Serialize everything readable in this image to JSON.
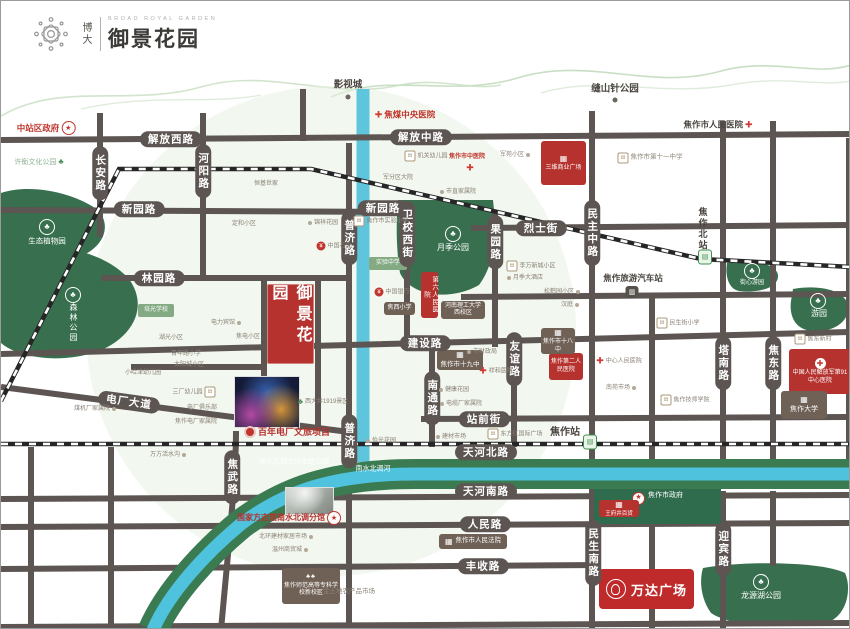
{
  "logo": {
    "brand": "博大",
    "en": "BROAD ROYAL GARDEN",
    "name": "御景花园"
  },
  "project": {
    "name": "御景花园"
  },
  "wanda": {
    "name": "万达广场"
  },
  "colors": {
    "road": "#5c5552",
    "park": "#38704f",
    "water": "#5ec5dd",
    "band_green": "#3b7b52",
    "accent_red": "#b5322e",
    "box_brown": "#6f6156",
    "tiny_text": "#8b8276",
    "red_text": "#c0362c"
  },
  "map": {
    "road_labels_h": [
      {
        "t": "解放西路",
        "x": 170,
        "y": 138
      },
      {
        "t": "解放中路",
        "x": 420,
        "y": 136
      },
      {
        "t": "新园路",
        "x": 138,
        "y": 208
      },
      {
        "t": "新园路",
        "x": 382,
        "y": 207
      },
      {
        "t": "林园路",
        "x": 158,
        "y": 277
      },
      {
        "t": "烈士街",
        "x": 540,
        "y": 227
      },
      {
        "t": "建设路",
        "x": 424,
        "y": 342
      },
      {
        "t": "电厂大道",
        "x": 128,
        "y": 401,
        "r": 8
      },
      {
        "t": "站前街",
        "x": 483,
        "y": 418
      },
      {
        "t": "天河北路",
        "x": 485,
        "y": 451
      },
      {
        "t": "天河南路",
        "x": 485,
        "y": 490
      },
      {
        "t": "人民路",
        "x": 484,
        "y": 523
      },
      {
        "t": "丰收路",
        "x": 482,
        "y": 565
      }
    ],
    "road_labels_v": [
      {
        "t": "长安路",
        "x": 99,
        "y": 172
      },
      {
        "t": "河阳路",
        "x": 202,
        "y": 170
      },
      {
        "t": "普济路",
        "x": 348,
        "y": 237
      },
      {
        "t": "普济路",
        "x": 348,
        "y": 440
      },
      {
        "t": "焦武路",
        "x": 231,
        "y": 476
      },
      {
        "t": "卫校西街",
        "x": 406,
        "y": 233
      },
      {
        "t": "果园路",
        "x": 494,
        "y": 241
      },
      {
        "t": "民主中路",
        "x": 591,
        "y": 232
      },
      {
        "t": "友谊路",
        "x": 513,
        "y": 358
      },
      {
        "t": "南通路",
        "x": 431,
        "y": 397
      },
      {
        "t": "塔南路",
        "x": 722,
        "y": 362
      },
      {
        "t": "焦东路",
        "x": 772,
        "y": 362
      },
      {
        "t": "民生南路",
        "x": 592,
        "y": 552
      },
      {
        "t": "迎宾路",
        "x": 722,
        "y": 548
      }
    ],
    "boxes": [
      {
        "t": "焦作市政府",
        "x": 593,
        "y": 488,
        "w": 127,
        "h": 35,
        "c": "green",
        "icon": "star",
        "lay": "rowtop",
        "fs": 7
      },
      {
        "t": "王府井百货",
        "x": 598,
        "y": 499,
        "w": 40,
        "h": 17,
        "c": "red",
        "icon": "building",
        "fs": 5.5
      },
      {
        "t": "三维商业广场",
        "x": 540,
        "y": 140,
        "w": 45,
        "h": 44,
        "c": "red",
        "icon": "building",
        "fs": 6
      },
      {
        "t": "第六人民医院",
        "x": 420,
        "y": 271,
        "w": 17,
        "h": 46,
        "c": "red",
        "dir": "v",
        "fs": 6.5
      },
      {
        "t": "焦作第二人民医院",
        "x": 548,
        "y": 352,
        "w": 34,
        "h": 27,
        "c": "red",
        "fs": 6
      },
      {
        "t": "中国人民解放军第91中心医院",
        "x": 788,
        "y": 348,
        "w": 62,
        "h": 45,
        "c": "red",
        "icon": "cross",
        "fs": 6
      },
      {
        "t": "焦作市十九中",
        "x": 436,
        "y": 349,
        "w": 46,
        "h": 20,
        "c": "brown",
        "icon": "building",
        "fs": 6.5
      },
      {
        "t": "焦作市十八中",
        "x": 540,
        "y": 327,
        "w": 34,
        "h": 26,
        "c": "brown",
        "icon": "building",
        "fs": 6
      },
      {
        "t": "河南理工大学西校区",
        "x": 440,
        "y": 300,
        "w": 44,
        "h": 18,
        "c": "brown",
        "fs": 6
      },
      {
        "t": "焦西小学",
        "x": 383,
        "y": 301,
        "w": 31,
        "h": 13,
        "c": "brown",
        "fs": 6
      },
      {
        "t": "实验中学",
        "x": 368,
        "y": 256,
        "w": 38,
        "h": 13,
        "c": "green2",
        "fs": 6
      },
      {
        "t": "培光学校",
        "x": 137,
        "y": 303,
        "w": 36,
        "h": 13,
        "c": "green2",
        "fs": 6
      },
      {
        "t": "焦作大学",
        "x": 780,
        "y": 390,
        "w": 46,
        "h": 28,
        "c": "brown",
        "icon": "building",
        "fs": 7
      },
      {
        "t": "焦作师范高等专科学校新校区",
        "x": 281,
        "y": 567,
        "w": 58,
        "h": 36,
        "c": "brown",
        "icon": "trees",
        "fs": 6
      },
      {
        "t": "焦作市人民法院",
        "x": 438,
        "y": 533,
        "w": 68,
        "h": 15,
        "c": "brown",
        "lay": "row",
        "icon": "building",
        "fs": 6.5
      }
    ],
    "pois": [
      {
        "t": "影视城",
        "x": 347,
        "y": 84,
        "cl": "dk",
        "fs": 9.5
      },
      {
        "x": 347,
        "y": 96,
        "ic": "dotd"
      },
      {
        "t": "缝山针公园",
        "x": 614,
        "y": 88,
        "cl": "dk",
        "fs": 9.5
      },
      {
        "x": 614,
        "y": 99,
        "ic": "dotd"
      },
      {
        "t": "焦煤中央医院",
        "x": 404,
        "y": 114,
        "cl": "red",
        "fs": 8.5,
        "ic": "cross"
      },
      {
        "t": "中站区政府",
        "x": 45,
        "y": 127,
        "cl": "red",
        "fs": 8.5,
        "icr": "star"
      },
      {
        "t": "焦作市人民医院",
        "x": 717,
        "y": 124,
        "cl": "dk",
        "fs": 8.5,
        "icr": "cross"
      },
      {
        "t": "许衡文化公园",
        "x": 38,
        "y": 161,
        "cl": "grn",
        "fs": 7,
        "icr": "treesg"
      },
      {
        "t": "焦作市第十一中学",
        "x": 649,
        "y": 157,
        "cl": "gray",
        "fs": 6.5,
        "ic": "school"
      },
      {
        "t": "机关幼儿园",
        "x": 425,
        "y": 155,
        "cl": "gray",
        "fs": 6,
        "ic": "school"
      },
      {
        "t": "焦作市中医院",
        "x": 466,
        "y": 156,
        "cl": "red",
        "fs": 6
      },
      {
        "x": 469,
        "y": 167,
        "ic": "cross"
      },
      {
        "t": "军苑小区",
        "x": 514,
        "y": 154,
        "cl": "gray",
        "fs": 6,
        "icr": "dots"
      },
      {
        "t": "军分区大院",
        "x": 397,
        "y": 177,
        "cl": "gray",
        "fs": 6
      },
      {
        "t": "恒基世家",
        "x": 265,
        "y": 183,
        "cl": "gray",
        "fs": 6
      },
      {
        "t": "定和小区",
        "x": 243,
        "y": 223,
        "cl": "gray",
        "fs": 6
      },
      {
        "t": "锦祥花园",
        "x": 322,
        "y": 222,
        "cl": "gray",
        "fs": 6,
        "ic": "dots"
      },
      {
        "t": "中国石化",
        "x": 333,
        "y": 245,
        "cl": "gray",
        "fs": 6,
        "ic": "bank"
      },
      {
        "t": "焦作市实验小学",
        "x": 380,
        "y": 220,
        "cl": "gray",
        "fs": 6,
        "ic": "school"
      },
      {
        "t": "中国银行",
        "x": 391,
        "y": 291,
        "cl": "gray",
        "fs": 6,
        "ic": "bank"
      },
      {
        "t": "市财政局",
        "x": 481,
        "y": 351,
        "cl": "gray",
        "fs": 6,
        "ic": "dots"
      },
      {
        "t": "祥和医院",
        "x": 495,
        "y": 370,
        "cl": "gray",
        "fs": 6,
        "ic": "cross"
      },
      {
        "t": "李万新城小区",
        "x": 530,
        "y": 265,
        "cl": "gray",
        "fs": 6,
        "ic": "school"
      },
      {
        "t": "月季大酒店",
        "x": 524,
        "y": 277,
        "cl": "gray",
        "fs": 6,
        "ic": "dots"
      },
      {
        "t": "松鹤园小区",
        "x": 561,
        "y": 291,
        "cl": "gray",
        "fs": 6,
        "icr": "dots"
      },
      {
        "t": "汉庭",
        "x": 569,
        "y": 304,
        "cl": "gray",
        "fs": 6,
        "icr": "dots"
      },
      {
        "t": "市直家属院",
        "x": 457,
        "y": 191,
        "cl": "gray",
        "fs": 6,
        "ic": "dots"
      },
      {
        "t": "民生街小学",
        "x": 677,
        "y": 322,
        "cl": "gray",
        "fs": 6,
        "ic": "school"
      },
      {
        "t": "中心人民医院",
        "x": 618,
        "y": 360,
        "cl": "gray",
        "fs": 6,
        "ic": "cross"
      },
      {
        "t": "南苑市场",
        "x": 620,
        "y": 387,
        "cl": "gray",
        "fs": 6,
        "icr": "dots"
      },
      {
        "t": "焦作技师学院",
        "x": 684,
        "y": 399,
        "cl": "gray",
        "fs": 6,
        "ic": "school"
      },
      {
        "t": "焦东新村",
        "x": 812,
        "y": 338,
        "cl": "gray",
        "fs": 6,
        "ic": "school"
      },
      {
        "t": "湖光小区",
        "x": 170,
        "y": 337,
        "cl": "gray",
        "fs": 6
      },
      {
        "t": "小哈津幼儿园",
        "x": 142,
        "y": 372,
        "cl": "gray",
        "fs": 6
      },
      {
        "t": "青年路小学",
        "x": 185,
        "y": 353,
        "cl": "gray",
        "fs": 6
      },
      {
        "t": "太阳城小区",
        "x": 188,
        "y": 364,
        "cl": "gray",
        "fs": 6
      },
      {
        "t": "电力宾馆",
        "x": 225,
        "y": 322,
        "cl": "gray",
        "fs": 6,
        "icr": "dots"
      },
      {
        "t": "焦电小区",
        "x": 247,
        "y": 336,
        "cl": "gray",
        "fs": 6
      },
      {
        "t": "三厂幼儿园",
        "x": 193,
        "y": 391,
        "cl": "gray",
        "fs": 6,
        "icr": "school"
      },
      {
        "t": "电厂俱乐部",
        "x": 201,
        "y": 407,
        "cl": "gray",
        "fs": 6
      },
      {
        "t": "焦作电厂家属院",
        "x": 195,
        "y": 421,
        "cl": "gray",
        "fs": 6
      },
      {
        "t": "煤机厂家属院",
        "x": 94,
        "y": 408,
        "cl": "gray",
        "fs": 6,
        "icr": "dots"
      },
      {
        "t": "西大井1919景区",
        "x": 322,
        "y": 401,
        "cl": "gray",
        "fs": 6,
        "ic": "treesg"
      },
      {
        "t": "万方活水沟",
        "x": 167,
        "y": 454,
        "cl": "gray",
        "fs": 6,
        "icr": "dots"
      },
      {
        "t": "百年电厂文旅项目",
        "x": 286,
        "y": 431,
        "cl": "redb",
        "fs": 9,
        "ic": "reddot"
      },
      {
        "t": "国家方志馆南水北调分馆",
        "x": 288,
        "y": 517,
        "cl": "redb",
        "fs": 8,
        "icr": "star"
      },
      {
        "t": "北环建材家居市场",
        "x": 285,
        "y": 536,
        "cl": "gray",
        "fs": 6,
        "icr": "dots"
      },
      {
        "t": "温州商贸城",
        "x": 289,
        "y": 549,
        "cl": "gray",
        "fs": 6,
        "icr": "dots"
      },
      {
        "t": "金土地农产品市场",
        "x": 345,
        "y": 591,
        "cl": "gray",
        "fs": 6.5,
        "ic": "dots"
      },
      {
        "t": "怡光花园",
        "x": 380,
        "y": 440,
        "cl": "gray",
        "fs": 6,
        "ic": "dots"
      },
      {
        "t": "东方红国际广场",
        "x": 514,
        "y": 433,
        "cl": "gray",
        "fs": 6,
        "ic": "school"
      },
      {
        "t": "建材市场",
        "x": 450,
        "y": 436,
        "cl": "gray",
        "fs": 6,
        "ic": "dots"
      },
      {
        "t": "健康花园",
        "x": 453,
        "y": 389,
        "cl": "gray",
        "fs": 6,
        "ic": "dots"
      },
      {
        "t": "电缆厂家属院",
        "x": 460,
        "y": 403,
        "cl": "gray",
        "fs": 6,
        "ic": "dots"
      },
      {
        "t": "焦作站",
        "x": 564,
        "y": 432,
        "cl": "dk",
        "fs": 10,
        "b": 1
      },
      {
        "x": 589,
        "y": 441,
        "ic": "train"
      },
      {
        "t": "焦作北站",
        "x": 701,
        "y": 228,
        "cl": "dk",
        "fs": 9,
        "dir": "v",
        "b": 1
      },
      {
        "x": 704,
        "y": 256,
        "ic": "train"
      },
      {
        "t": "焦作旅游汽车站",
        "x": 632,
        "y": 277,
        "cl": "dk",
        "fs": 8.5,
        "b": 1
      },
      {
        "x": 631,
        "y": 291,
        "ic": "bus"
      },
      {
        "t": "南水北调文化主题公园",
        "x": 293,
        "y": 461,
        "cl": "wh",
        "fs": 7
      },
      {
        "t": "南水北调河",
        "x": 372,
        "y": 468,
        "cl": "wh",
        "fs": 7
      },
      {
        "x": 46,
        "y": 226,
        "ic": "treesc"
      },
      {
        "t": "生态植物园",
        "x": 46,
        "y": 240,
        "cl": "wh",
        "fs": 7.5
      },
      {
        "x": 72,
        "y": 294,
        "ic": "treesc"
      },
      {
        "t": "森林公园",
        "x": 72,
        "y": 322,
        "cl": "wh",
        "fs": 8,
        "dir": "v"
      },
      {
        "x": 452,
        "y": 233,
        "ic": "treesc"
      },
      {
        "t": "月季公园",
        "x": 452,
        "y": 247,
        "cl": "wh",
        "fs": 8
      },
      {
        "x": 751,
        "y": 270,
        "ic": "treesc"
      },
      {
        "t": "街心游园",
        "x": 751,
        "y": 282,
        "cl": "wh",
        "fs": 6
      },
      {
        "x": 817,
        "y": 300,
        "ic": "treesc"
      },
      {
        "t": "游园",
        "x": 818,
        "y": 313,
        "cl": "wh",
        "fs": 8
      },
      {
        "x": 760,
        "y": 581,
        "ic": "treesc"
      },
      {
        "t": "龙源湖公园",
        "x": 760,
        "y": 595,
        "cl": "wh",
        "fs": 8
      }
    ]
  }
}
